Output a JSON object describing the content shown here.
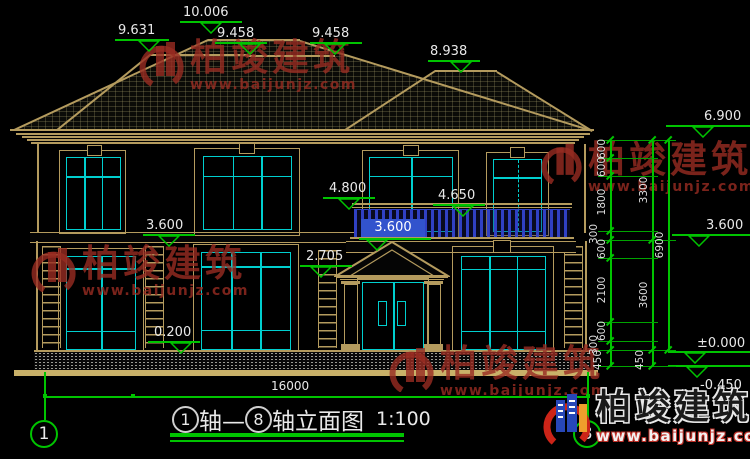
{
  "drawing": {
    "caption": {
      "axis_from": "1",
      "mid": "轴—",
      "axis_to": "8",
      "tail": "轴立面图",
      "scale": "1:100"
    },
    "axes": {
      "left": "1",
      "right": "8"
    }
  },
  "elevations": {
    "top": [
      "9.631",
      "10.006",
      "9.458",
      "9.458",
      "8.938"
    ],
    "left": {
      "upper": "3.600",
      "lower": "0.200"
    },
    "mid": {
      "m1": "4.800",
      "m2": "4.650",
      "selected": "3.600",
      "m3": "2.705"
    },
    "right": {
      "r1": "6.900",
      "r2": "3.600",
      "r3": "±0.000",
      "r4": "-0.450"
    }
  },
  "dimensions": {
    "right_col1": [
      "600",
      "600",
      "1800",
      "300",
      "600",
      "2100",
      "600",
      "300",
      "450"
    ],
    "right_col2": [
      "3300",
      "3600",
      "450"
    ],
    "right_col3": [
      "6900"
    ],
    "bottom_total": "16000"
  },
  "watermark": {
    "brand": "柏竣建筑",
    "url": "www.baijunjz.com"
  },
  "colors": {
    "background": "#000000",
    "dimension_green": "#00c400",
    "line_tan": "#b49b5e",
    "window_cyan": "#00cfcf",
    "baluster_blue": "#3040c4",
    "selection_blue": "#3253cd",
    "watermark_red": "#982c22",
    "logo_blue": "#2747b8",
    "logo_orange": "#ef9d2c",
    "logo_red": "#cc2418"
  }
}
